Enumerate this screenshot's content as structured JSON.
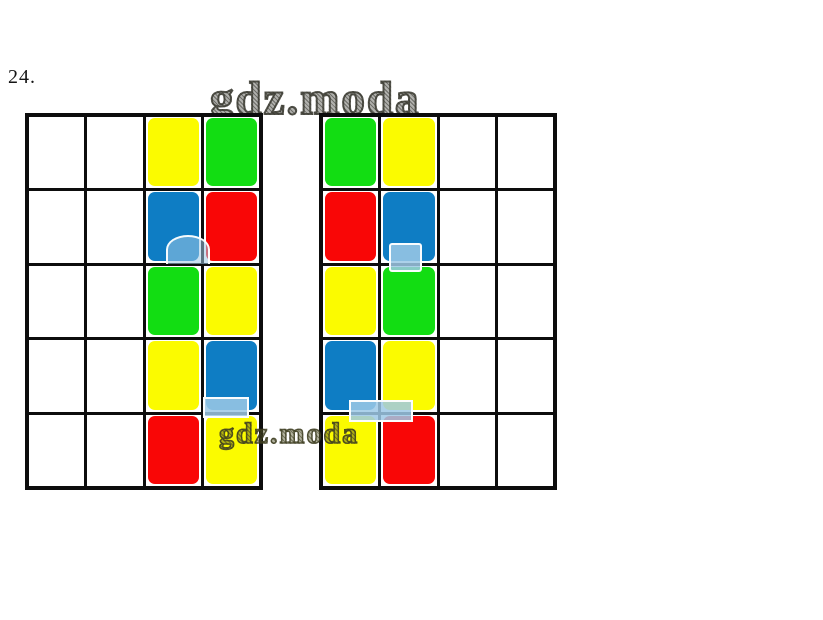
{
  "page": {
    "background": "#FFFFFF"
  },
  "exercise": {
    "number_label": "24."
  },
  "watermarks": {
    "top": "gdz.moda",
    "bottom": "gdz.moda"
  },
  "colors": {
    "yellow": "#FBFB00",
    "green": "#12DD12",
    "blue": "#0E7DC4",
    "red": "#F90606",
    "white": "#FFFFFF",
    "grid_line": "#0D0D0D",
    "artifact_blue": "#9EC9E6",
    "watermark_gray": "#4A4A40"
  },
  "puzzle": {
    "left_grid": {
      "rows": 5,
      "cols": 4,
      "cells": [
        [
          "white",
          "white",
          "yellow",
          "green"
        ],
        [
          "white",
          "white",
          "blue",
          "red"
        ],
        [
          "white",
          "white",
          "green",
          "yellow"
        ],
        [
          "white",
          "white",
          "yellow",
          "blue"
        ],
        [
          "white",
          "white",
          "red",
          "yellow"
        ]
      ]
    },
    "right_grid": {
      "rows": 5,
      "cols": 4,
      "cells": [
        [
          "green",
          "yellow",
          "white",
          "white"
        ],
        [
          "red",
          "blue",
          "white",
          "white"
        ],
        [
          "yellow",
          "green",
          "white",
          "white"
        ],
        [
          "blue",
          "yellow",
          "white",
          "white"
        ],
        [
          "yellow",
          "red",
          "white",
          "white"
        ]
      ]
    }
  }
}
